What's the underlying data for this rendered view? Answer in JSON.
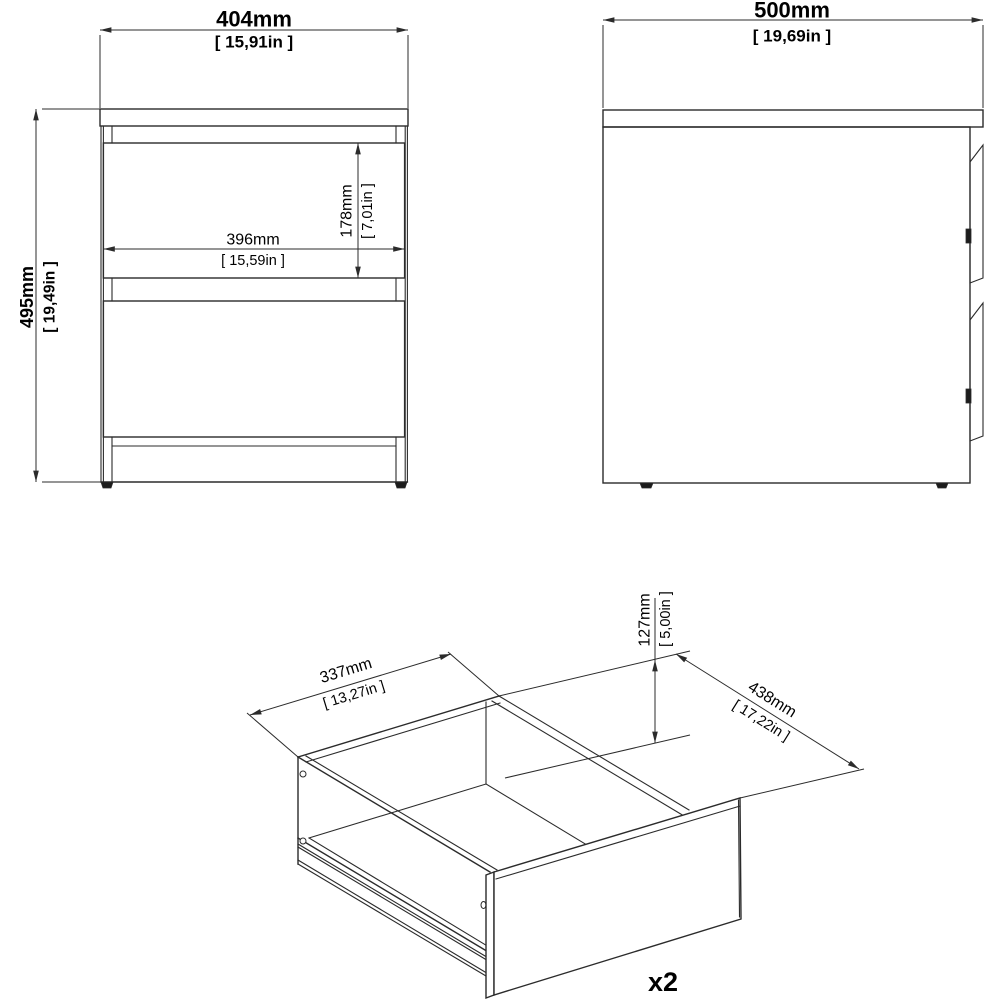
{
  "colors": {
    "background": "#ffffff",
    "line": "#2b2b2b",
    "text": "#000000",
    "dark": "#1c1c1c"
  },
  "front_view": {
    "width_dim": {
      "mm": "404mm",
      "in": "[ 15,91in ]"
    },
    "height_dim": {
      "mm": "495mm",
      "in": "[ 19,49in ]"
    },
    "inner_width_dim": {
      "mm": "396mm",
      "in": "[ 15,59in ]"
    },
    "drawer_height_dim": {
      "mm": "178mm",
      "in": "[ 7,01in ]"
    }
  },
  "side_view": {
    "depth_dim": {
      "mm": "500mm",
      "in": "[ 19,69in ]"
    }
  },
  "drawer_view": {
    "width_dim": {
      "mm": "337mm",
      "in": "[ 13,27in ]"
    },
    "height_dim": {
      "mm": "127mm",
      "in": "[ 5,00in ]"
    },
    "front_width_dim": {
      "mm": "438mm",
      "in": "[ 17,22in ]"
    },
    "quantity_label": "x2"
  }
}
